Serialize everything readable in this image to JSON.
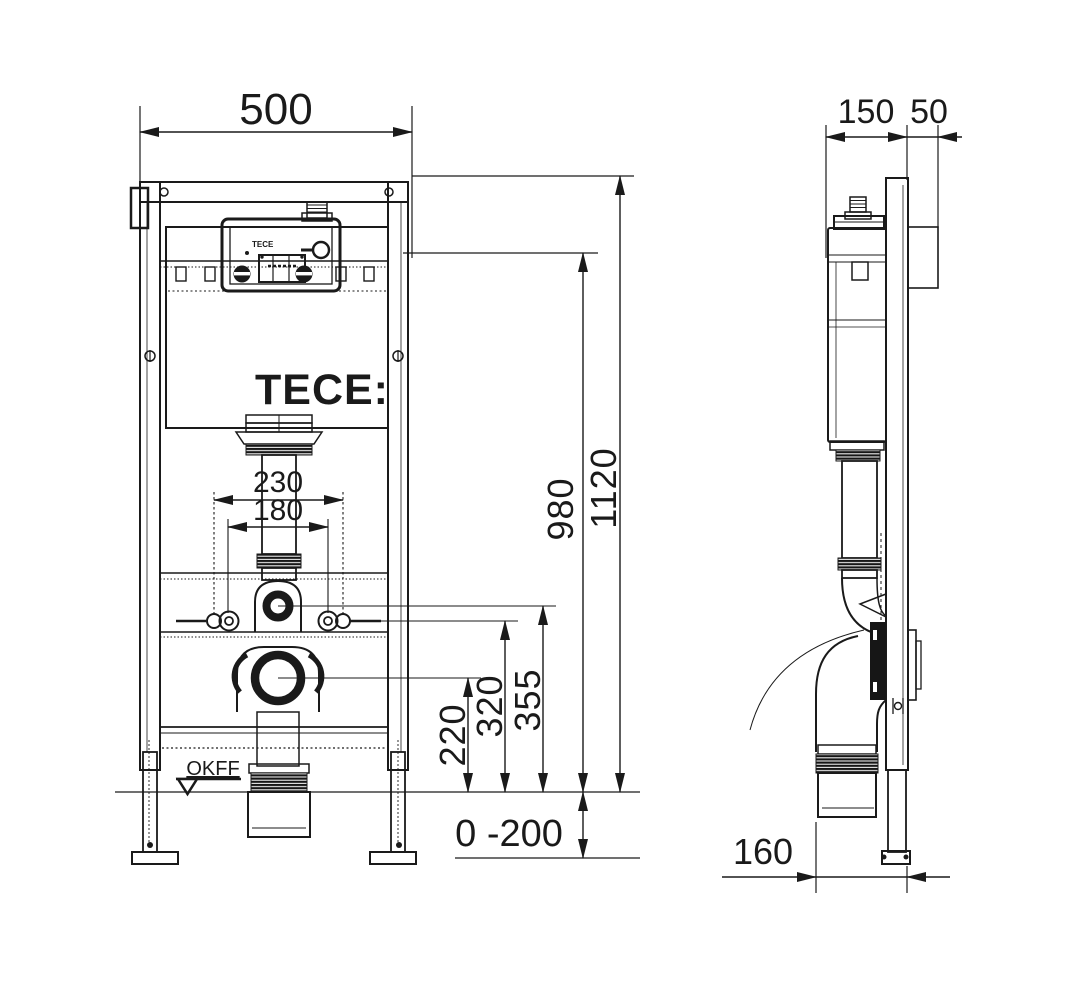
{
  "meta": {
    "background": "#ffffff",
    "ink": "#1a1a1a"
  },
  "logo": {
    "main": "TECE:",
    "module": "TECE"
  },
  "front": {
    "width": "500",
    "total_height": "1120",
    "upper_ref_height": "980",
    "flush_elbow_height": "355",
    "fixing_bolt_height": "320",
    "outlet_height": "220",
    "bolt_spacing_outer": "230",
    "bolt_spacing_inner": "180",
    "foot_adjust_range": "0 -200",
    "floor_label": "OKFF"
  },
  "side": {
    "frame_depth": "150",
    "front_offset": "50",
    "outlet_offset": "160"
  }
}
